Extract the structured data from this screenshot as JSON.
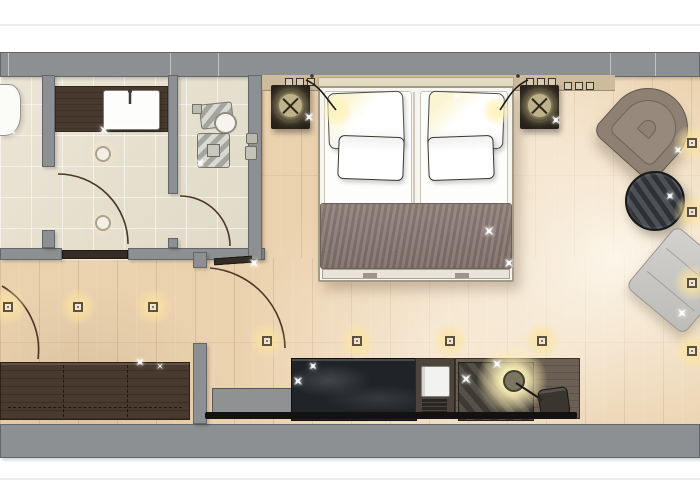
{
  "meta": {
    "type": "architectural-floor-plan",
    "subject": "hotel-room-top-down-rendering",
    "visible_text": "none"
  },
  "palette": {
    "wall_gray": "#8d9092",
    "wall_edge": "#63666a",
    "bath_tile": "#e8e2d0",
    "wood_floor": "#ebd2af",
    "dark_wood": "#483a2e",
    "bed_runner": "#8b7a73",
    "marble_black": "#202327",
    "warm_glow": "#f8ecc4",
    "linen_white": "#fdfdfc",
    "lounge_gray": "#c9c7c4"
  },
  "rooms": [
    {
      "name": "wc-room"
    },
    {
      "name": "vanity-room"
    },
    {
      "name": "shower-room"
    },
    {
      "name": "entry-corridor"
    },
    {
      "name": "bedroom"
    }
  ],
  "furniture": [
    "toilet",
    "vanity-counter-with-sink",
    "shower-fixture",
    "shower-drain",
    "double-bed-with-runner",
    "nightstand-with-lamp-left",
    "nightstand-with-lamp-right",
    "armchair",
    "round-side-table",
    "lounge-chair",
    "wardrobe",
    "luggage-bench",
    "marble-console",
    "minibar-fridge",
    "desk-with-lamp",
    "desk-stool",
    "tv-panel"
  ],
  "floor_lights": [
    {
      "x": 8,
      "y": 307
    },
    {
      "x": 78,
      "y": 307
    },
    {
      "x": 153,
      "y": 307
    },
    {
      "x": 267,
      "y": 341
    },
    {
      "x": 357,
      "y": 341
    },
    {
      "x": 450,
      "y": 341
    },
    {
      "x": 542,
      "y": 341
    },
    {
      "x": 692,
      "y": 143
    },
    {
      "x": 692,
      "y": 212
    },
    {
      "x": 692,
      "y": 283
    },
    {
      "x": 692,
      "y": 351
    }
  ],
  "ceiling_spots": [
    {
      "x": 101,
      "y": 152
    },
    {
      "x": 101,
      "y": 221
    }
  ],
  "sparkles": [
    {
      "x": 12,
      "y": 131,
      "s": 10
    },
    {
      "x": 104,
      "y": 130,
      "s": 12
    },
    {
      "x": 200,
      "y": 163,
      "s": 10
    },
    {
      "x": 309,
      "y": 117,
      "s": 12
    },
    {
      "x": 556,
      "y": 120,
      "s": 12
    },
    {
      "x": 457,
      "y": 96,
      "s": 9
    },
    {
      "x": 489,
      "y": 231,
      "s": 14
    },
    {
      "x": 509,
      "y": 263,
      "s": 12
    },
    {
      "x": 678,
      "y": 150,
      "s": 10
    },
    {
      "x": 670,
      "y": 196,
      "s": 10
    },
    {
      "x": 682,
      "y": 313,
      "s": 12
    },
    {
      "x": 140,
      "y": 362,
      "s": 10
    },
    {
      "x": 160,
      "y": 366,
      "s": 9
    },
    {
      "x": 254,
      "y": 263,
      "s": 12
    },
    {
      "x": 298,
      "y": 381,
      "s": 12
    },
    {
      "x": 313,
      "y": 366,
      "s": 10
    },
    {
      "x": 466,
      "y": 379,
      "s": 14
    },
    {
      "x": 497,
      "y": 364,
      "s": 12
    }
  ]
}
